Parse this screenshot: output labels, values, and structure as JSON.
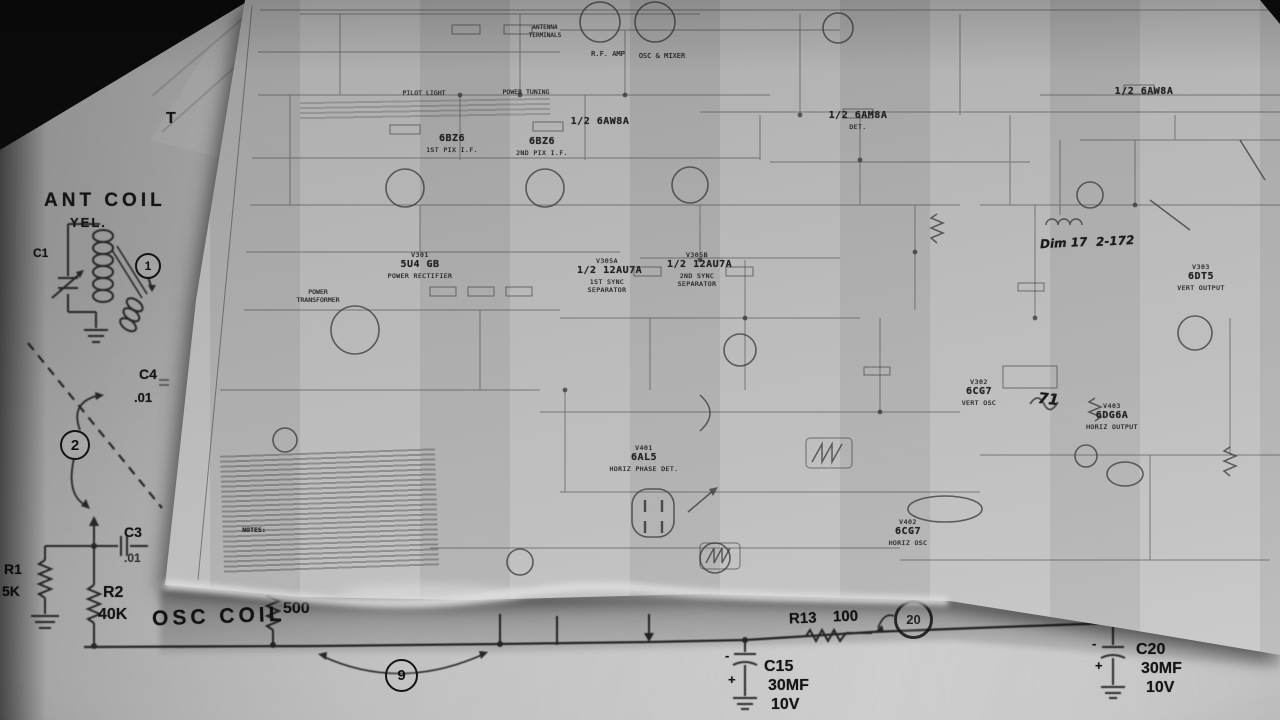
{
  "fg": {
    "t_partial": "T",
    "ant_coil": "ANT COIL",
    "yel": "YEL.",
    "c1": "C1",
    "callout_1": "1",
    "callout_2": "2",
    "c4": "C4",
    "c4_value": ".01",
    "c3": "C3",
    "c3_value": ".01",
    "r1": "R1",
    "r1_value": "5K",
    "r2": "R2",
    "r2_value": "40K",
    "osc_coil": "OSC COIL",
    "r500": "500",
    "callout_9": "9",
    "r13": "R13",
    "r13_value": "100",
    "callout_20": "20",
    "c15": "C15",
    "c15_value": "30MF",
    "c15_voltage": "10V",
    "c20": "C20",
    "c20_value": "30MF",
    "c20_voltage": "10V",
    "minus": "-",
    "plus": "+"
  },
  "schem": {
    "tubes": [
      {
        "id": "V301",
        "type": "5U4 GB",
        "role": "POWER RECTIFIER"
      },
      {
        "id": "",
        "type": "6BZ6",
        "role": "1ST PIX I.F."
      },
      {
        "id": "",
        "type": "6BZ6",
        "role": "2ND PIX I.F."
      },
      {
        "id": "",
        "type": "1/2 6AW8A",
        "role": ""
      },
      {
        "id": "",
        "type": "1/2 6AM8A",
        "role": "DET."
      },
      {
        "id": "",
        "type": "1/2 6AW8A",
        "role": ""
      },
      {
        "id": "V305A",
        "type": "1/2 12AU7A",
        "role": "1ST SYNC SEPARATOR"
      },
      {
        "id": "V305B",
        "type": "1/2 12AU7A",
        "role": "2ND SYNC SEPARATOR"
      },
      {
        "id": "V401",
        "type": "6AL5",
        "role": "HORIZ PHASE DET."
      },
      {
        "id": "V402",
        "type": "6CG7",
        "role": "HORIZ OSC"
      },
      {
        "id": "V302",
        "type": "6CG7",
        "role": "VERT OSC"
      },
      {
        "id": "V303",
        "type": "6DT5",
        "role": "VERT OUTPUT"
      },
      {
        "id": "V403",
        "type": "6DG6A",
        "role": "HORIZ OUTPUT"
      }
    ],
    "tuner": {
      "rf_amp": "R.F. AMP",
      "osc_mixer": "OSC & MIXER",
      "antenna_terminals": "ANTENNA TERMINALS",
      "pilot_light": "PILOT LIGHT",
      "power_tuning": "POWER TUNING"
    },
    "power_transformer": "POWER TRANSFORMER",
    "notes_heading": "NOTES:",
    "handwriting": {
      "dim": "Dim 17",
      "ref": "2-172",
      "mark": "71"
    }
  }
}
